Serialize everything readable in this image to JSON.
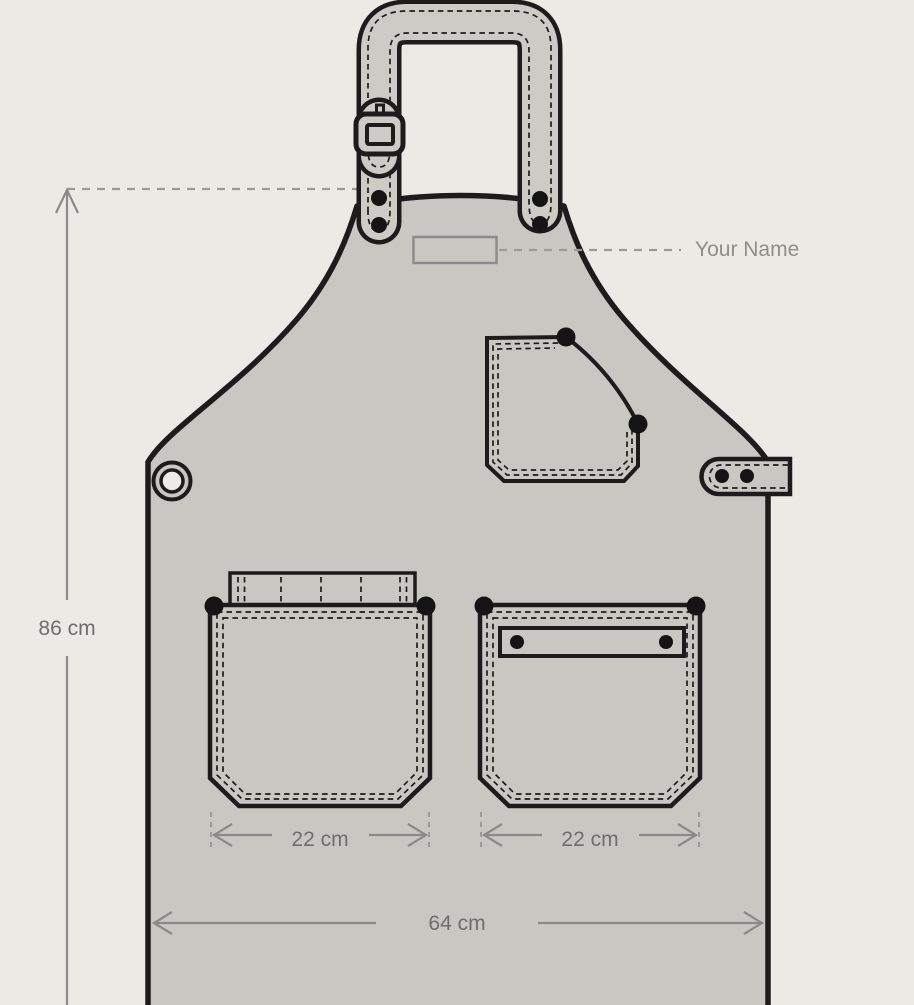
{
  "diagram": {
    "subject": "Apron measurement specification drawing",
    "annotations": {
      "name_label": "Your Name",
      "height_dimension": "86 cm",
      "left_pocket_width": "22 cm",
      "right_pocket_width": "22 cm",
      "hem_width": "64 cm"
    },
    "colors": {
      "background": "#ECEAE4",
      "fabric": "#C9C7C2",
      "strap_fabric": "#CDCBC6",
      "outline": "#1C1C1C",
      "dimension_line": "#8A8A8A",
      "dashed_guide": "#9A9A96",
      "dimension_text": "#6E6E6E",
      "name_text": "#8F8E8A",
      "name_tag_outline": "#8A8A8A",
      "grommet_hole": "#EDEBE5"
    }
  }
}
